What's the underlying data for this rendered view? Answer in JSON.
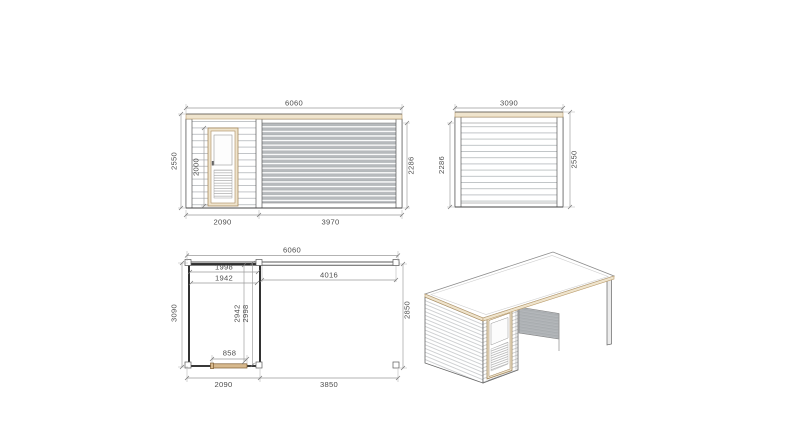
{
  "views": {
    "front_elevation": {
      "total_width": "6060",
      "height_total": "2550",
      "door_height": "2000",
      "wall_height": "2286",
      "cabin_width": "2090",
      "slat_width": "3970"
    },
    "side_elevation": {
      "total_width": "3090",
      "wall_height": "2286",
      "height_total": "2550"
    },
    "floor_plan": {
      "total_width": "6060",
      "inner_width_front": "1998",
      "inner_width": "1942",
      "terrace_opening": "4016",
      "depth_total": "3090",
      "inner_depth": "2942",
      "inner_depth_outer": "2998",
      "door_width": "858",
      "cabin_width": "2090",
      "terrace_width": "3850",
      "terrace_depth": "2850"
    },
    "colors": {
      "wood_trim": "#b99b6b",
      "wood_fill": "#efe4cd",
      "door_leaf": "#d7b98e",
      "slat_gray": "#b7babd",
      "outline": "#555555",
      "dimension": "#9a9a9a",
      "text": "#4d4d4d"
    }
  }
}
